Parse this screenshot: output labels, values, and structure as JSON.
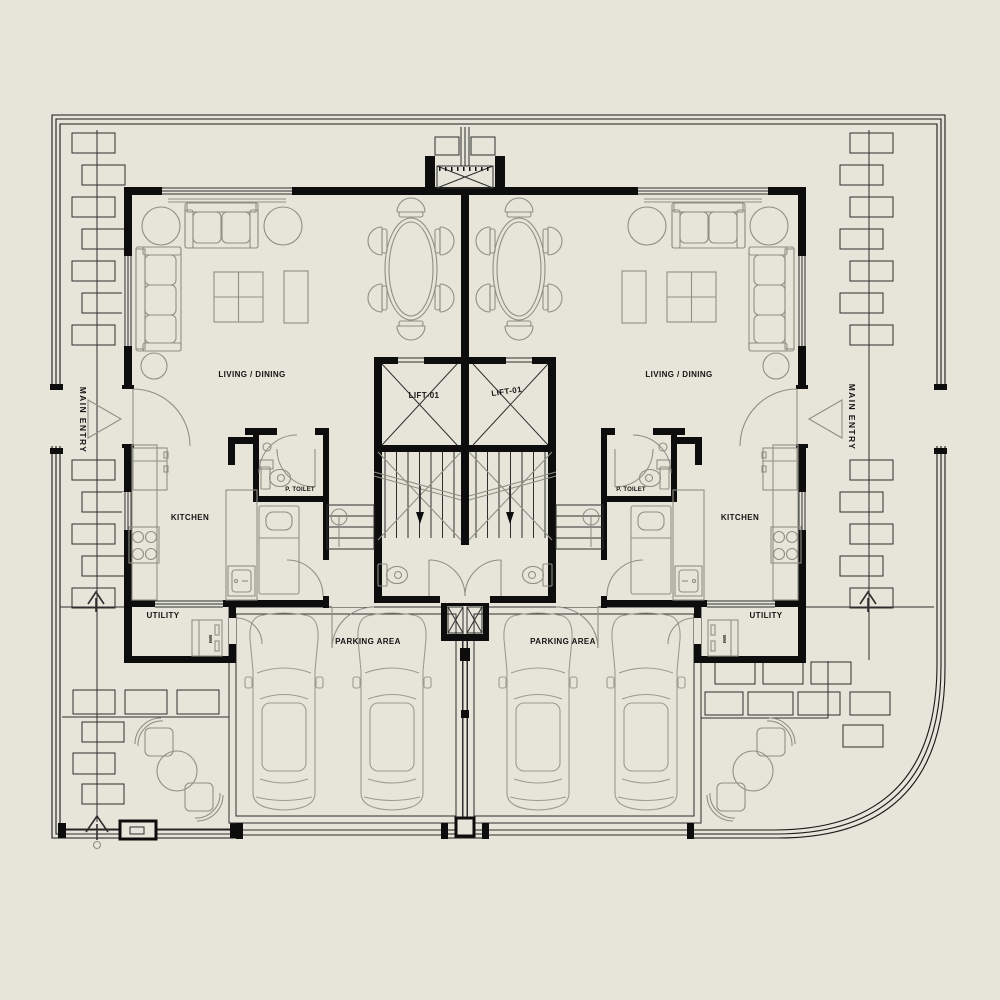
{
  "drawing": {
    "type": "architectural floor plan - symmetric duplex villa ground floor",
    "background": "#e7e5d9",
    "wall_color": "#0d0d0d",
    "line_color": "#2e2e2e",
    "furniture_color": "#8f8f85",
    "text_color": "#141414",
    "rooms": {
      "living_dining_left": "LIVING / DINING",
      "living_dining_right": "LIVING / DINING",
      "kitchen_left": "KITCHEN",
      "kitchen_right": "KITCHEN",
      "lift_left": "LIFT-01",
      "lift_right": "LIFT-01",
      "powder_toilet_left": "P. TOILET",
      "powder_toilet_right": "P. TOILET",
      "utility_left": "UTILITY",
      "utility_right": "UTILITY",
      "parking_left": "PARKING AREA",
      "parking_right": "PARKING AREA"
    },
    "annotations": {
      "main_entry_left": "MAIN ENTRY",
      "main_entry_right": "MAIN ENTRY",
      "washing_machine_left": "WM",
      "washing_machine_right": "WM"
    }
  }
}
